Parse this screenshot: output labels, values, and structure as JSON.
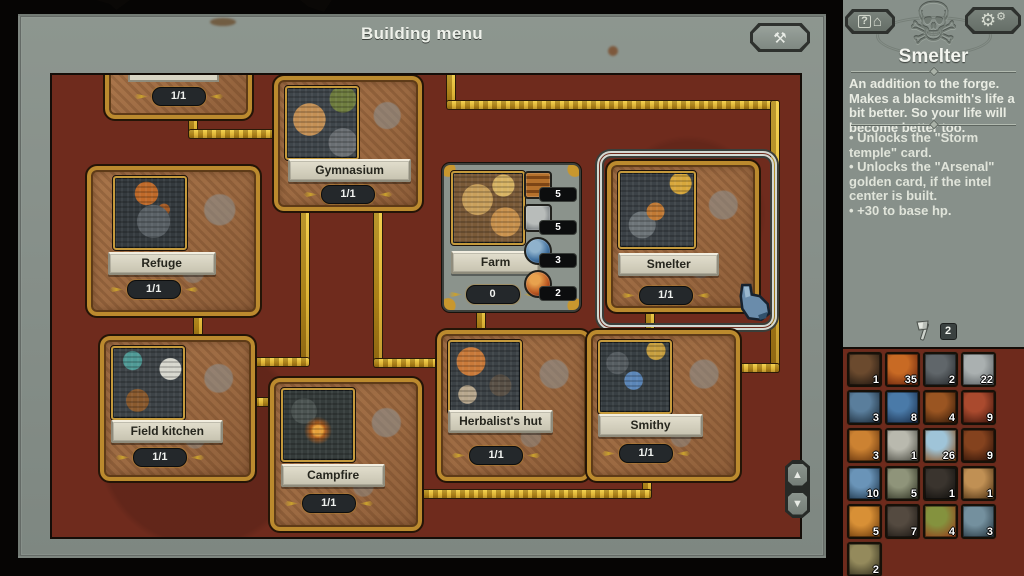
{
  "window": {
    "title": "Building menu"
  },
  "icons": {
    "close": "⚒",
    "gear_big": "⚙",
    "gear_small": "⚙",
    "help": "?",
    "house": "⌂",
    "skull_emblem": "☠",
    "scroll_up": "▲",
    "scroll_down": "▼"
  },
  "cards": [
    {
      "id": "partial-top",
      "label": "",
      "count": "1/1"
    },
    {
      "id": "gymnasium",
      "label": "Gymnasium",
      "count": "1/1"
    },
    {
      "id": "refuge",
      "label": "Refuge",
      "count": "1/1"
    },
    {
      "id": "farm",
      "label": "Farm",
      "count": "0",
      "costs": [
        {
          "icon": "wood-planks",
          "value": "5"
        },
        {
          "icon": "stone",
          "value": "5"
        },
        {
          "icon": "blue-orb",
          "value": "3"
        },
        {
          "icon": "red-orb",
          "value": "2"
        }
      ]
    },
    {
      "id": "smelter",
      "label": "Smelter",
      "count": "1/1",
      "selected": true
    },
    {
      "id": "field-kitchen",
      "label": "Field kitchen",
      "count": "1/1"
    },
    {
      "id": "campfire",
      "label": "Campfire",
      "count": "1/1"
    },
    {
      "id": "herbalist-hut",
      "label": "Herbalist's hut",
      "count": "1/1"
    },
    {
      "id": "smithy",
      "label": "Smithy",
      "count": "1/1"
    }
  ],
  "sidebar": {
    "title": "Smelter",
    "description": "An addition to the forge. Makes a blacksmith's life a bit better. So your life will become better too.",
    "effects": [
      "• Unlocks the \"Storm temple\" card.",
      "• Unlocks the \"Arsenal\" golden card, if the intel center is built.",
      "• +30 to base hp."
    ],
    "tool_count": "2",
    "inventory": [
      {
        "icon": "roots",
        "count": "1",
        "c1": "#6b4a2e",
        "c2": "#241a12"
      },
      {
        "icon": "raw-meat",
        "count": "35",
        "c1": "#c86a24",
        "c2": "#6e2810"
      },
      {
        "icon": "coal",
        "count": "2",
        "c1": "#60666a",
        "c2": "#2b2e31"
      },
      {
        "icon": "stone",
        "count": "22",
        "c1": "#aab0b0",
        "c2": "#5f6567"
      },
      {
        "icon": "crystal",
        "count": "3",
        "c1": "#5a7e9c",
        "c2": "#20303f"
      },
      {
        "icon": "water-orb",
        "count": "8",
        "c1": "#4a7aa8",
        "c2": "#1d3350"
      },
      {
        "icon": "claw",
        "count": "4",
        "c1": "#9a5522",
        "c2": "#3c1e0a"
      },
      {
        "icon": "copper-ore",
        "count": "9",
        "c1": "#aa4a2e",
        "c2": "#481a0e"
      },
      {
        "icon": "amber-orb",
        "count": "3",
        "c1": "#cc8232",
        "c2": "#6a3810"
      },
      {
        "icon": "skull",
        "count": "1",
        "c1": "#b9b9ae",
        "c2": "#55554c"
      },
      {
        "icon": "chest-eye",
        "count": "26",
        "c1": "#9fc4d8",
        "c2": "#8a5526"
      },
      {
        "icon": "horn",
        "count": "9",
        "c1": "#84421e",
        "c2": "#34160a"
      },
      {
        "icon": "blue-sphere",
        "count": "10",
        "c1": "#6a94b8",
        "c2": "#223a50"
      },
      {
        "icon": "arrows",
        "count": "5",
        "c1": "#8f947a",
        "c2": "#393c2c"
      },
      {
        "icon": "dark-fist",
        "count": "1",
        "c1": "#3a342e",
        "c2": "#14120f"
      },
      {
        "icon": "fang",
        "count": "1",
        "c1": "#c09054",
        "c2": "#583a1a"
      },
      {
        "icon": "orange-globe",
        "count": "5",
        "c1": "#d89036",
        "c2": "#74400f"
      },
      {
        "icon": "paw",
        "count": "7",
        "c1": "#544a40",
        "c2": "#221d18"
      },
      {
        "icon": "herbs",
        "count": "4",
        "c1": "#84923e",
        "c2": "#94461f"
      },
      {
        "icon": "shell",
        "count": "3",
        "c1": "#74909e",
        "c2": "#2e3f49"
      },
      {
        "icon": "gear-skull",
        "count": "2",
        "c1": "#948a5c",
        "c2": "#3a3622"
      }
    ]
  }
}
